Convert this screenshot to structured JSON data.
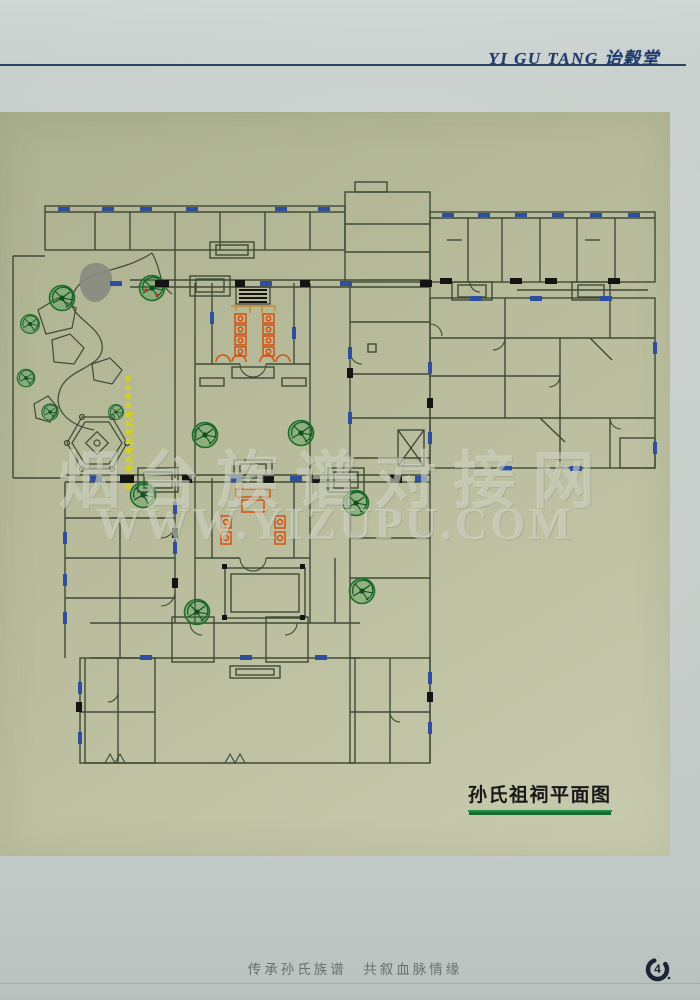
{
  "header": {
    "title": "YI GU TANG 诒榖堂"
  },
  "plan": {
    "label": "孙氏祖祠平面图",
    "watermark_line1": "烟台族谱对接网",
    "watermark_line2": "WWW.YIZUPU.COM"
  },
  "footer": {
    "slogan": "传承孙氏族谱　共叙血脉情缘",
    "page_number": "4"
  },
  "colors": {
    "header_navy": "#1e3a6d",
    "panel_olive": "#b9bd9e",
    "plan_line": "#3e4a36",
    "tree_green": "#1d6e2a",
    "furniture_orange": "#d4500f",
    "window_blue": "#2d4f9e",
    "path_yellow": "#d6ce28",
    "underline_green": "#1e9243"
  }
}
